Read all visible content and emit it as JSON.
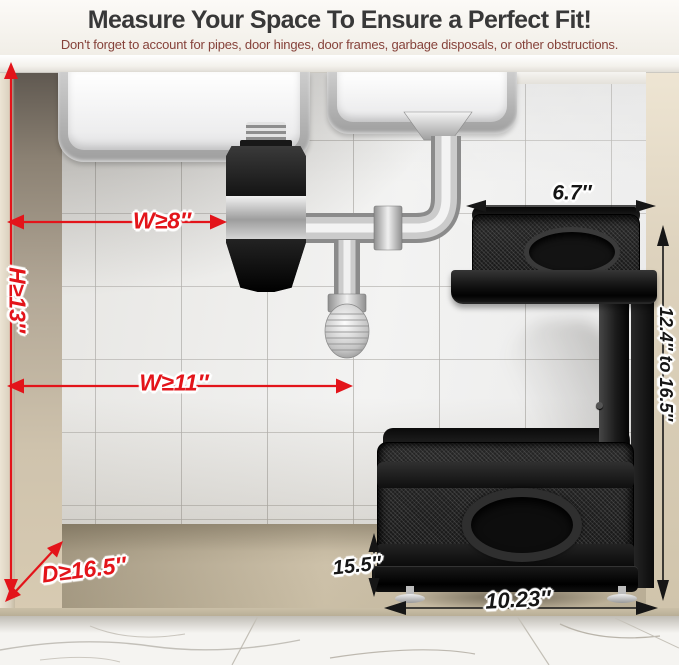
{
  "header": {
    "title": "Measure Your Space To Ensure a Perfect Fit!",
    "subtitle": "Don't forget to account for pipes, door hinges, door frames, garbage disposals, or other obstructions."
  },
  "dimensions": {
    "min_width_disposal": "W≥8″",
    "min_height": "H≥13″",
    "min_width_rack": "W≥11″",
    "min_depth": "D≥16.5″",
    "top_basket_width": "6.7″",
    "adjustable_height_range": "12.4″ to 16.5″",
    "rack_height": "15.5″",
    "rack_width": "10.23″"
  },
  "colors": {
    "dimension_red": "#e3141a",
    "dimension_black": "#161616",
    "title_text": "#383838",
    "subtitle_text": "#86423a"
  }
}
